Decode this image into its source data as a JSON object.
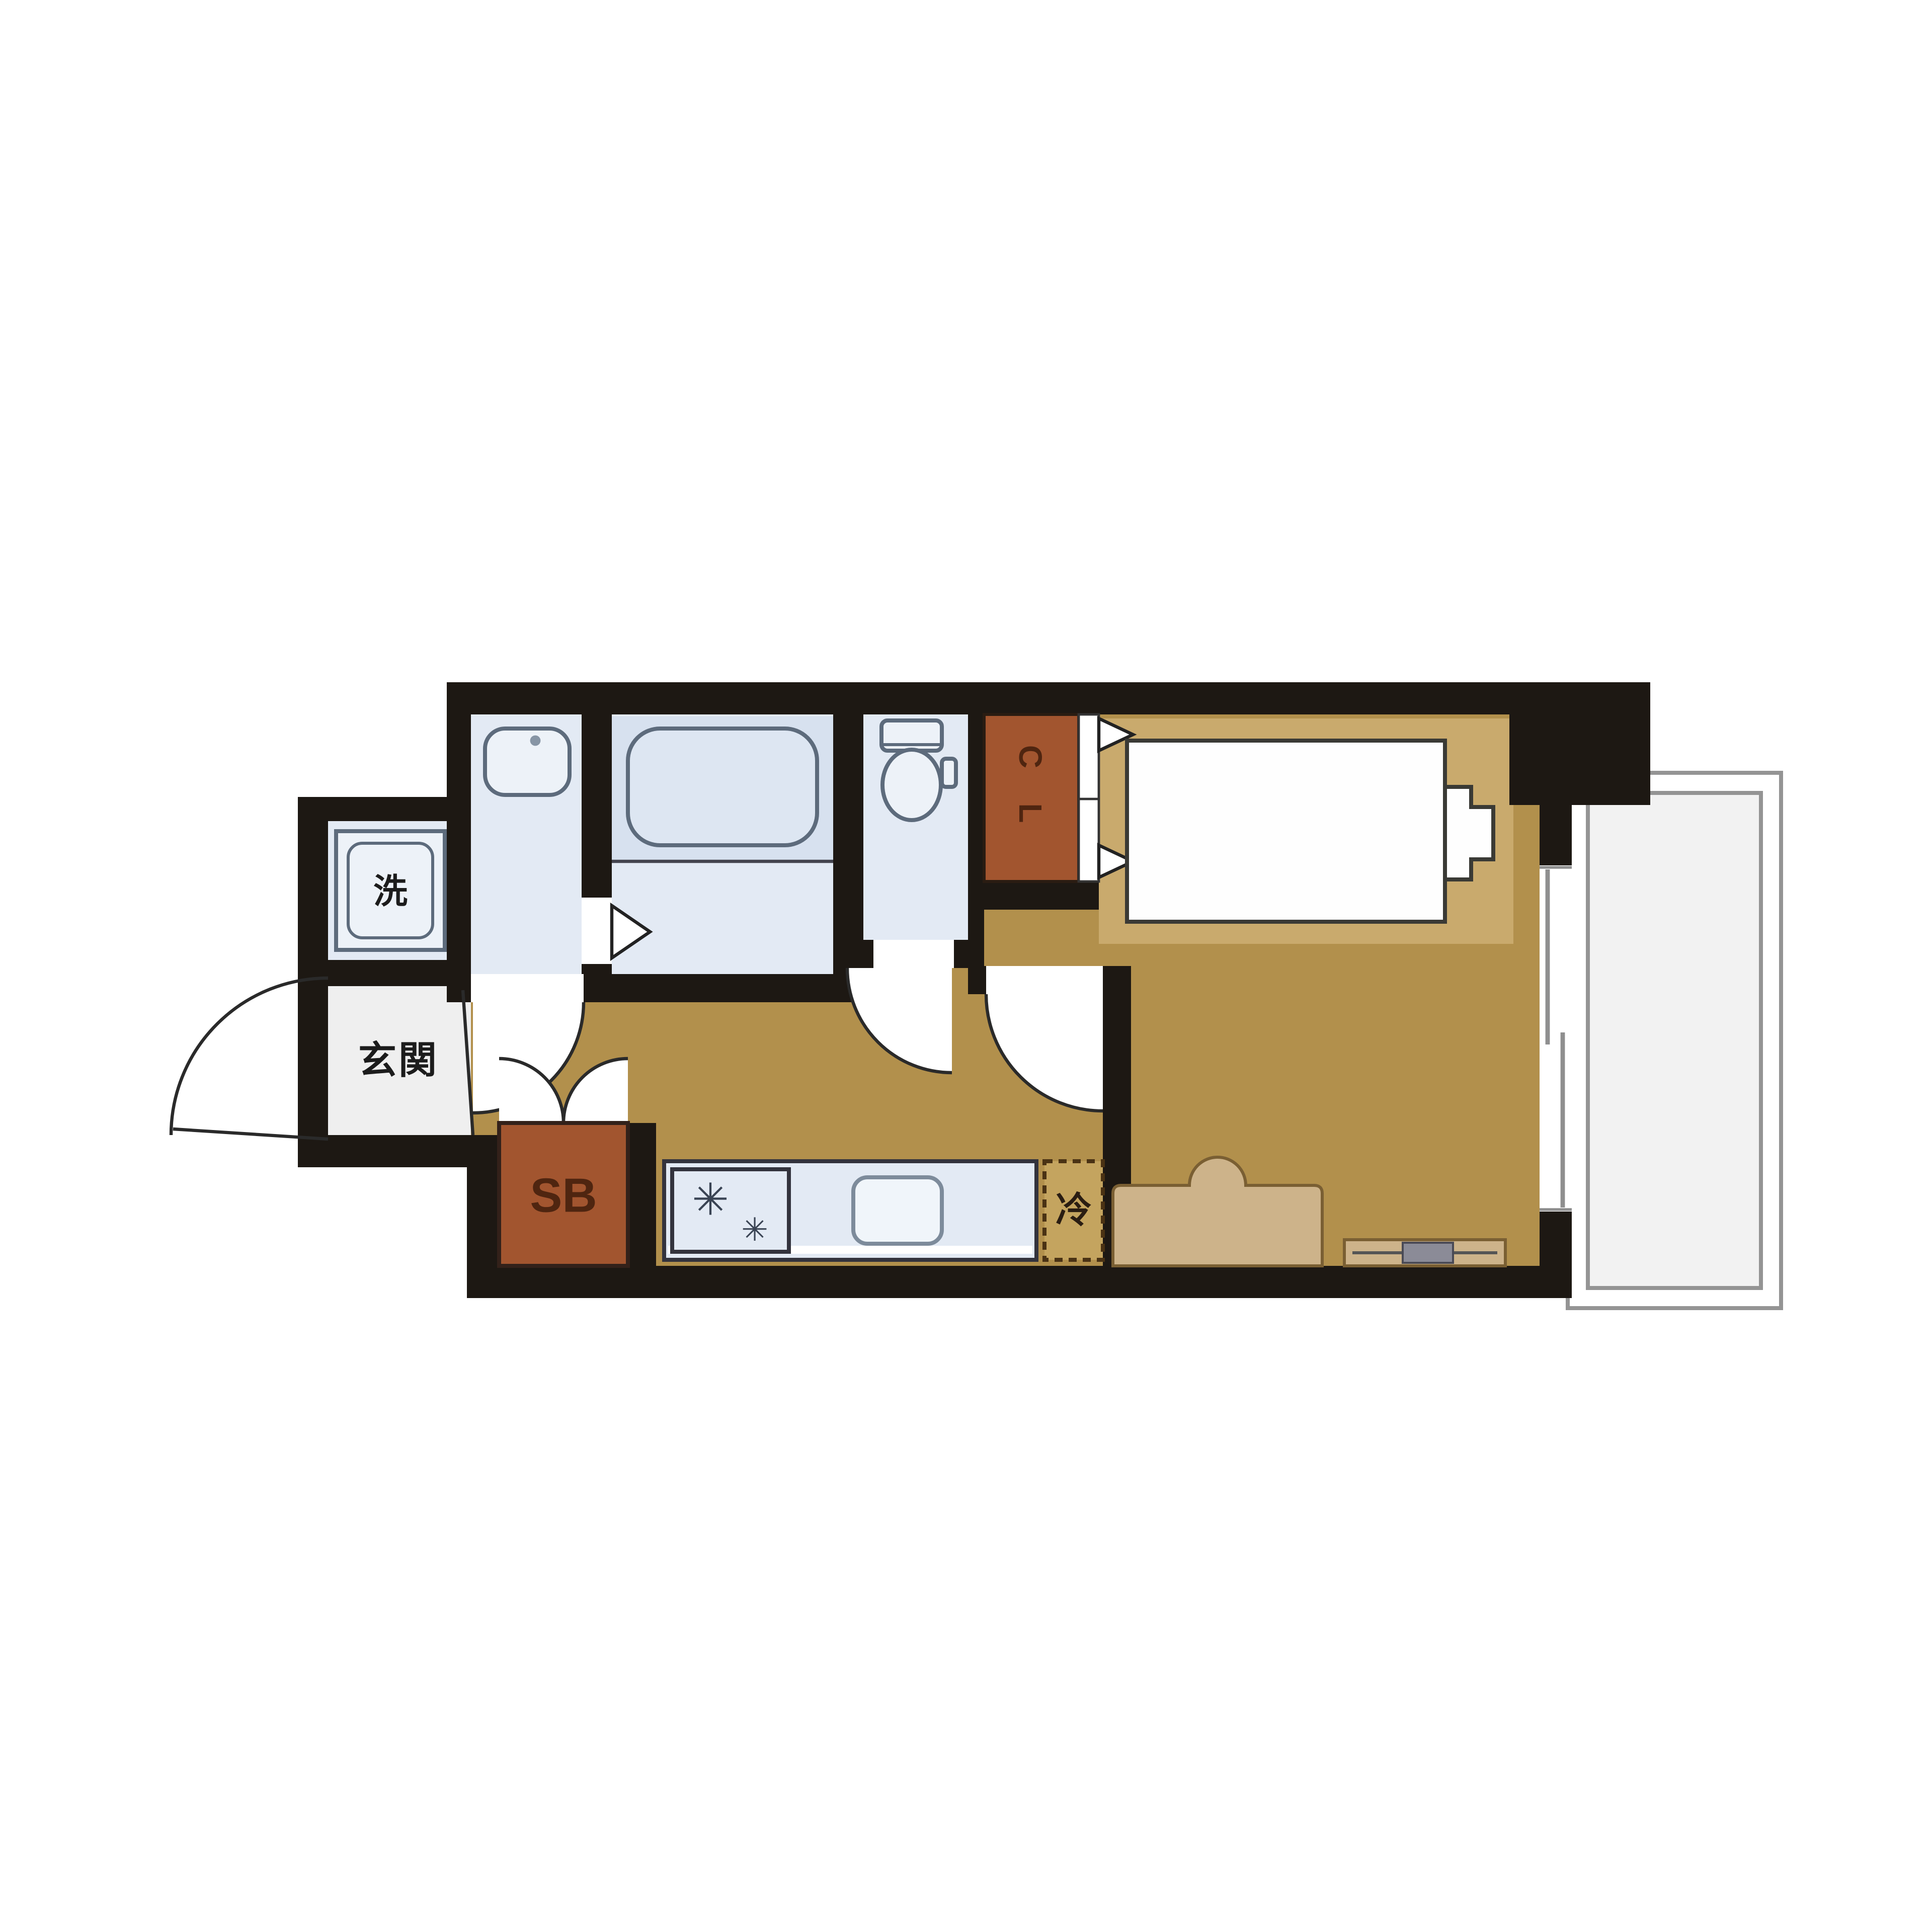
{
  "floorplan": {
    "labels": {
      "entrance": "玄関",
      "washing_machine": "洗",
      "closet_letters": [
        "C",
        "L"
      ],
      "shoe_box": "SB",
      "refrigerator": "冷",
      "stove_burner_symbol_large": "✳",
      "stove_burner_symbol_small": "✳"
    },
    "colors": {
      "wall": "#1d1813",
      "floor": "#b2904c",
      "mat": "#c9aa6d",
      "wet_room": "#e3eaf4",
      "wet_room_dark": "#d7e1ef",
      "storage_brown": "#a2552f",
      "entrance_floor": "#efefef",
      "balcony": "#f2f2f2"
    },
    "icons": [
      "washing-machine-icon",
      "wash-basin-icon",
      "bathtub-icon",
      "toilet-icon",
      "closet-double-door-icon",
      "stove-burners-icon",
      "kitchen-sink-icon",
      "refrigerator-box-icon",
      "bed-icon",
      "sofa-icon",
      "tv-board-icon",
      "entrance-door-arc-icon",
      "door-swing-icon",
      "balcony-window-icon"
    ]
  }
}
